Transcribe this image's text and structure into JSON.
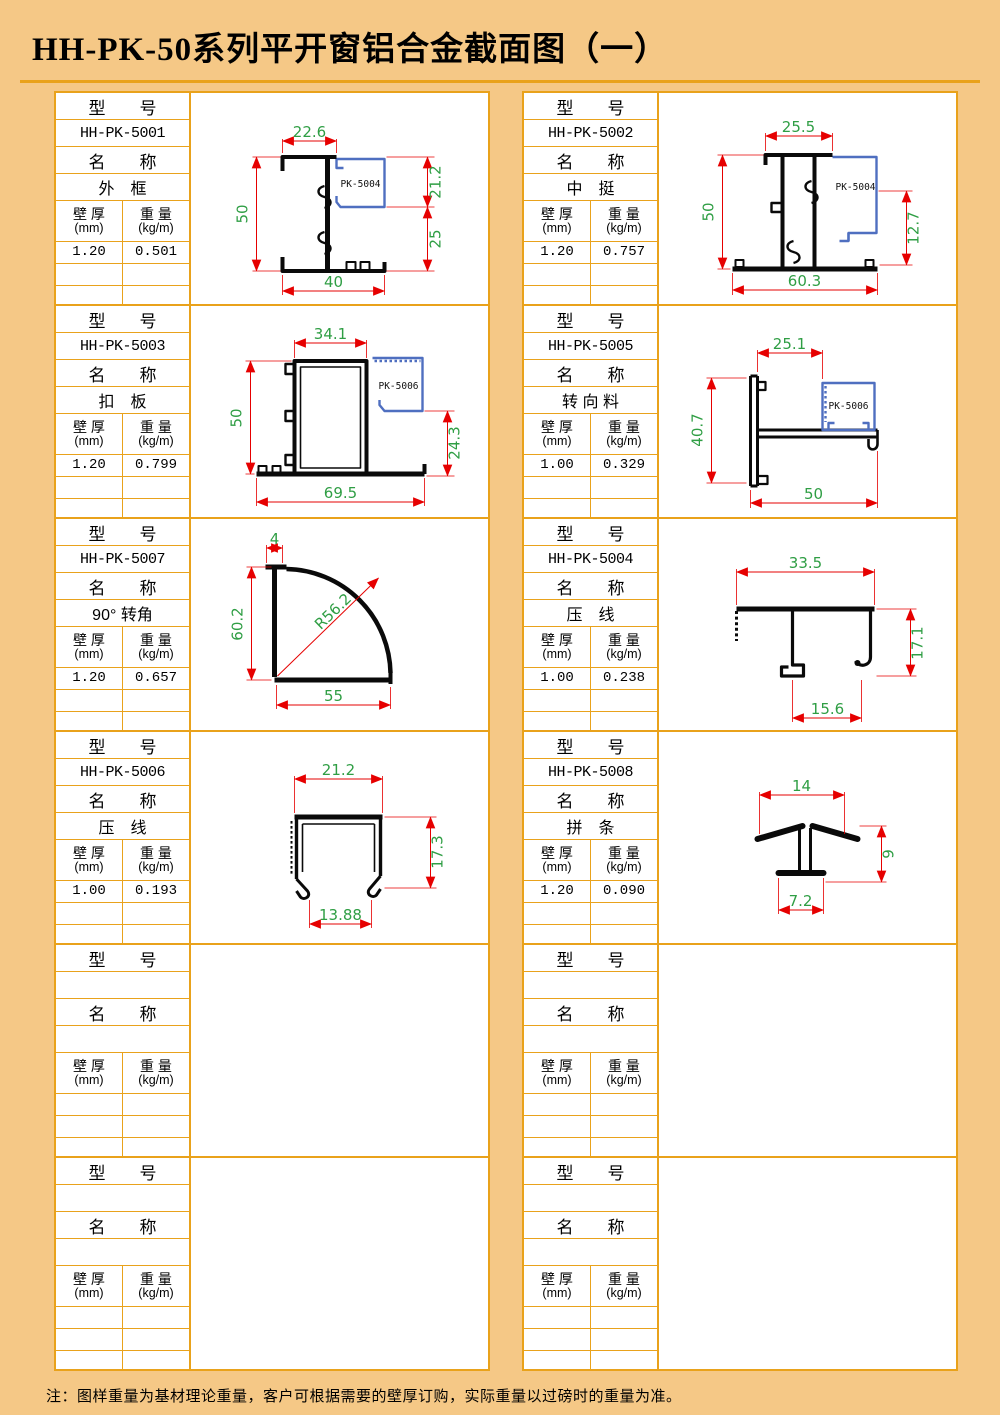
{
  "page": {
    "title": "HH-PK-50系列平开窗铝合金截面图（一）",
    "footnote": "注：图样重量为基材理论重量，客户可根据需要的壁厚订购，实际重量以过磅时的重量为准。"
  },
  "labels": {
    "model_header": "型　　号",
    "name_header": "名　　称",
    "thickness_l1": "壁 厚",
    "thickness_l2": "(mm)",
    "weight_l1": "重 量",
    "weight_l2": "(kg/m)"
  },
  "cells": [
    {
      "model": "HH-PK-5001",
      "name": "外　框",
      "thickness": "1.20",
      "weight": "0.501",
      "insert_label": "PK-5004",
      "dims": {
        "top": "22.6",
        "left": "50",
        "right_top": "21.2",
        "right_bottom": "25",
        "bottom": "40"
      }
    },
    {
      "model": "HH-PK-5002",
      "name": "中　挺",
      "thickness": "1.20",
      "weight": "0.757",
      "insert_label": "PK-5004",
      "dims": {
        "top": "25.5",
        "left": "50",
        "right": "12.7",
        "bottom": "60.3"
      }
    },
    {
      "model": "HH-PK-5003",
      "name": "扣　板",
      "thickness": "1.20",
      "weight": "0.799",
      "insert_label": "PK-5006",
      "dims": {
        "top": "34.1",
        "left": "50",
        "right": "24.3",
        "bottom": "69.5"
      }
    },
    {
      "model": "HH-PK-5005",
      "name": "转 向 料",
      "thickness": "1.00",
      "weight": "0.329",
      "insert_label": "PK-5006",
      "dims": {
        "top": "25.1",
        "left": "40.7",
        "bottom": "50"
      }
    },
    {
      "model": "HH-PK-5007",
      "name": "90° 转角",
      "thickness": "1.20",
      "weight": "0.657",
      "dims": {
        "top": "4",
        "left": "60.2",
        "radius": "R56.2",
        "bottom": "55"
      }
    },
    {
      "model": "HH-PK-5004",
      "name": "压　线",
      "thickness": "1.00",
      "weight": "0.238",
      "dims": {
        "top": "33.5",
        "right": "17.1",
        "bottom": "15.6"
      }
    },
    {
      "model": "HH-PK-5006",
      "name": "压　线",
      "thickness": "1.00",
      "weight": "0.193",
      "dims": {
        "top": "21.2",
        "right": "17.3",
        "bottom": "13.88"
      }
    },
    {
      "model": "HH-PK-5008",
      "name": "拼　条",
      "thickness": "1.20",
      "weight": "0.090",
      "dims": {
        "top": "14",
        "right": "9",
        "bottom": "7.2"
      }
    },
    {
      "model": "",
      "name": "",
      "thickness": "",
      "weight": ""
    },
    {
      "model": "",
      "name": "",
      "thickness": "",
      "weight": ""
    },
    {
      "model": "",
      "name": "",
      "thickness": "",
      "weight": ""
    },
    {
      "model": "",
      "name": "",
      "thickness": "",
      "weight": ""
    }
  ]
}
